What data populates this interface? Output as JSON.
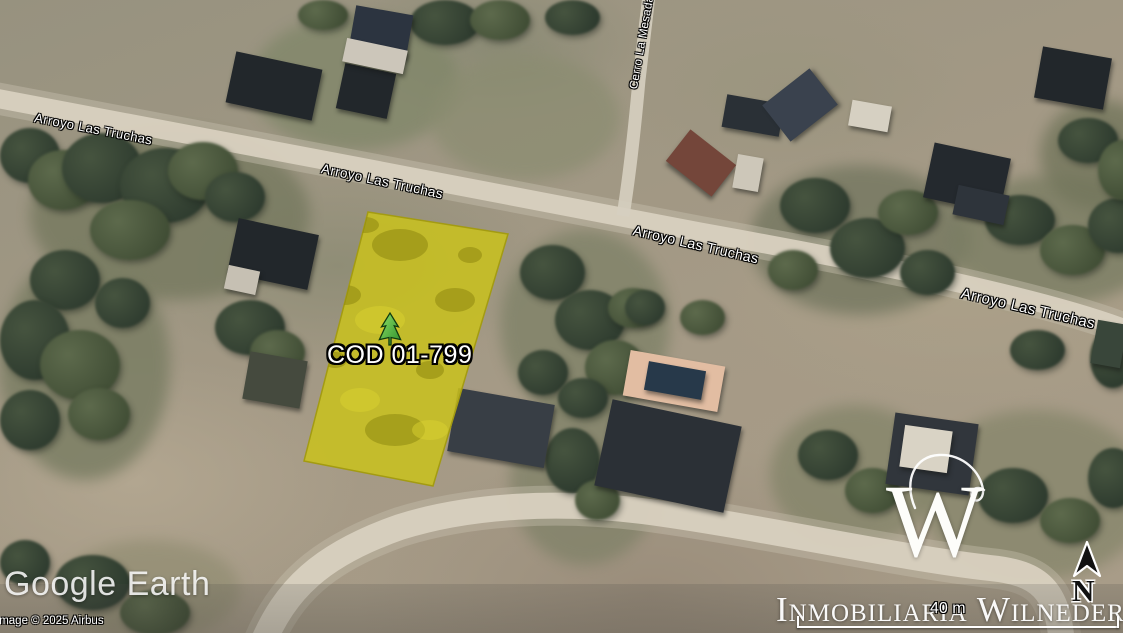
{
  "map": {
    "provider": "Google Earth",
    "copyright": "Image © 2025 Airbus"
  },
  "parcel": {
    "code": "COD 01-799",
    "marker_icon": "tree-icon",
    "highlight_color": "#c9c11d"
  },
  "streets": {
    "main": "Arroyo Las Truchas",
    "cross": "Cerro La Mesada"
  },
  "branding": {
    "logo_letter": "W",
    "name": "Inmobiliaria Wilneder"
  },
  "compass": {
    "label": "N"
  },
  "scale": {
    "label": "40 m"
  },
  "palette": {
    "parcel_fill": "#c9c11d",
    "parcel_edge": "#a39b12",
    "road": "#d8d0bf",
    "terrain": "#a09884",
    "tree_dark": "#2e3b2f",
    "label_text": "#ffffff"
  }
}
